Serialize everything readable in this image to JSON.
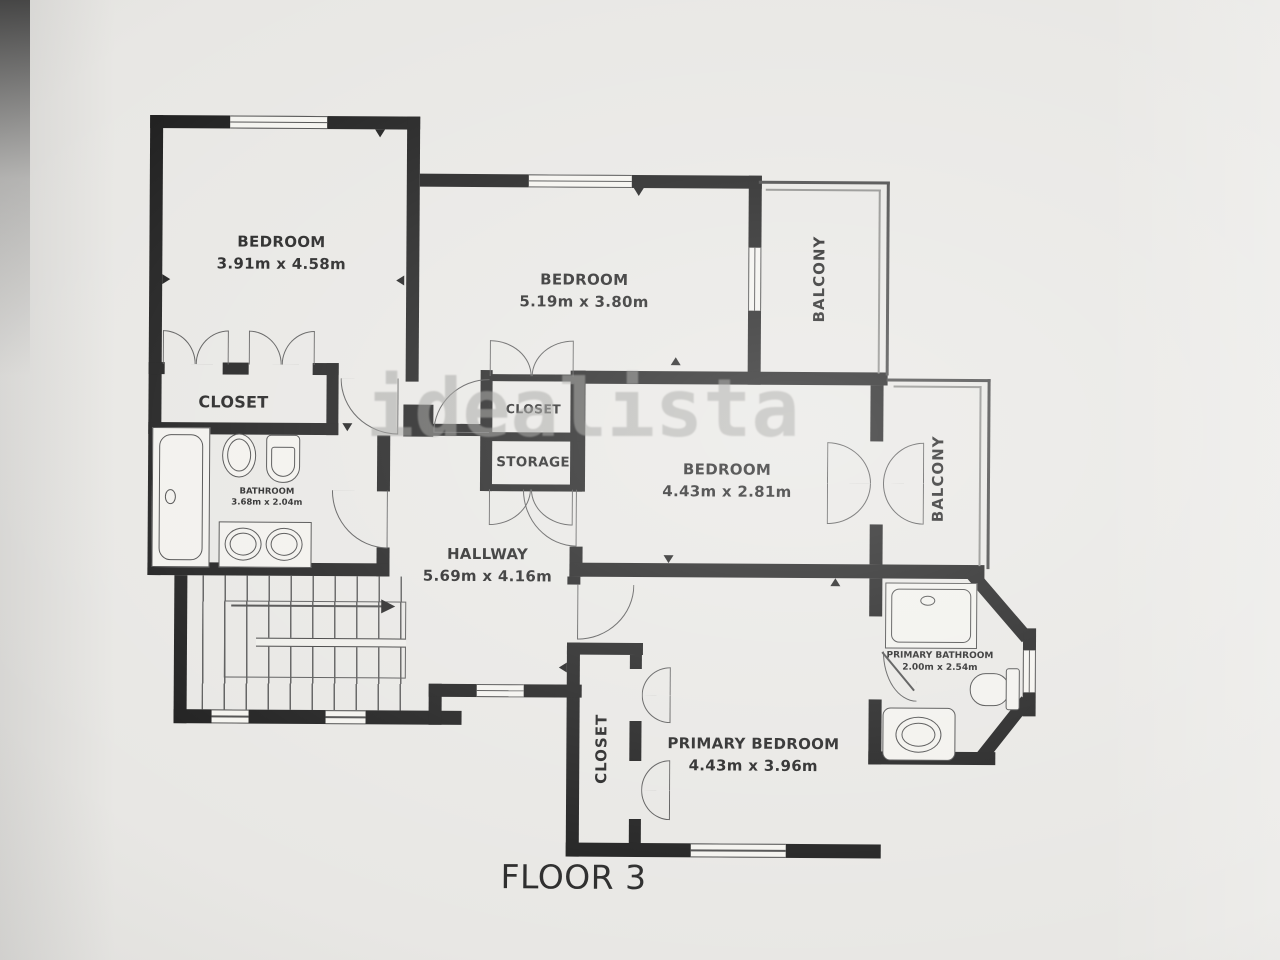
{
  "floorplan": {
    "title": "FLOOR 3",
    "watermark": "idealista",
    "rooms": {
      "bedroom1": {
        "name": "BEDROOM",
        "dims": "3.91m x 4.58m"
      },
      "bedroom2": {
        "name": "BEDROOM",
        "dims": "5.19m x 3.80m"
      },
      "bedroom3": {
        "name": "BEDROOM",
        "dims": "4.43m x 2.81m"
      },
      "primary_bedroom": {
        "name": "PRIMARY BEDROOM",
        "dims": "4.43m x 3.96m"
      },
      "hallway": {
        "name": "HALLWAY",
        "dims": "5.69m x 4.16m"
      },
      "bathroom": {
        "name": "BATHROOM",
        "dims": "3.68m x 2.04m"
      },
      "primary_bathroom": {
        "name": "PRIMARY BATHROOM",
        "dims": "2.00m x 2.54m"
      },
      "closet_bedroom1": {
        "name": "CLOSET"
      },
      "closet_bedroom2": {
        "name": "CLOSET"
      },
      "storage": {
        "name": "STORAGE"
      },
      "closet_primary": {
        "name": "CLOSET"
      },
      "balcony_top": {
        "name": "BALCONY"
      },
      "balcony_right": {
        "name": "BALCONY"
      }
    },
    "colors": {
      "wall": "#1b1b1b",
      "label": "#1f1f1f",
      "watermark": "#999996",
      "background": "#e8e7e4"
    }
  }
}
